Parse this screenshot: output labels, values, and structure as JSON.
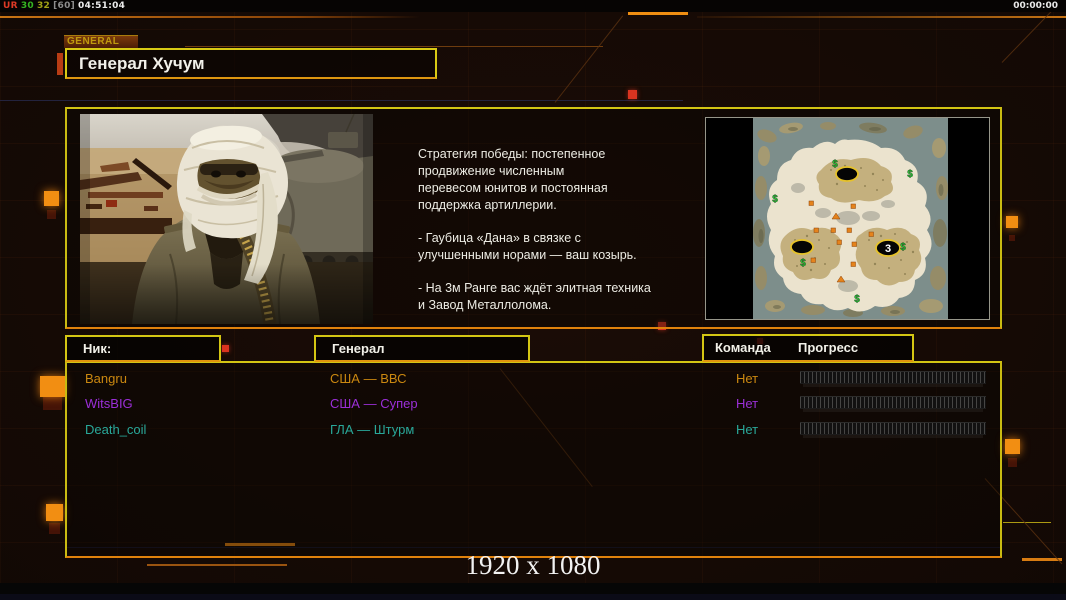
{
  "hud": {
    "perf_ur": "UR",
    "perf_fps": "30",
    "perf_max": "32",
    "perf_cap": "[60]",
    "perf_time": "04:51:04",
    "timer": "00:00:00",
    "perf_colors": {
      "ur": "#dd3a26",
      "fps": "#35b522",
      "max": "#a2a216",
      "cap": "#8d8d8d",
      "time": "#ececec"
    }
  },
  "tab": {
    "label": "GENERAL"
  },
  "header": {
    "title": "Генерал Хучум"
  },
  "briefing": {
    "p1": "Стратегия победы: постепенное\nпродвижение численным\nперевесом юнитов и постоянная\nподдержка артиллерии.",
    "p2": "- Гаубица «Дана» в связке с\nулучшенными норами — ваш козырь.",
    "p3": "- На 3м Ранге вас ждёт элитная техника\nи Завод Металлолома."
  },
  "minimap": {
    "start_label": "3",
    "supply_symbol": "$"
  },
  "roster": {
    "col_nick": "Ник:",
    "col_general": "Генерал",
    "col_team": "Команда",
    "col_progress": "Прогресс",
    "players": [
      {
        "nick": "Bangru",
        "general": "США — ВВС",
        "team": "Нет",
        "color": "#cb8810"
      },
      {
        "nick": "WitsBIG",
        "general": "США — Супер",
        "team": "Нет",
        "color": "#9b2fd8"
      },
      {
        "nick": "Death_coil",
        "general": "ГЛА — Штурм",
        "team": "Нет",
        "color": "#29a89a"
      }
    ]
  },
  "footer": {
    "resolution": "1920 x 1080"
  },
  "colors": {
    "panel_border_top": "#d3c513",
    "panel_border_bottom": "#e0820c",
    "accent_orange": "#f28e12",
    "accent_red": "#d93420"
  }
}
